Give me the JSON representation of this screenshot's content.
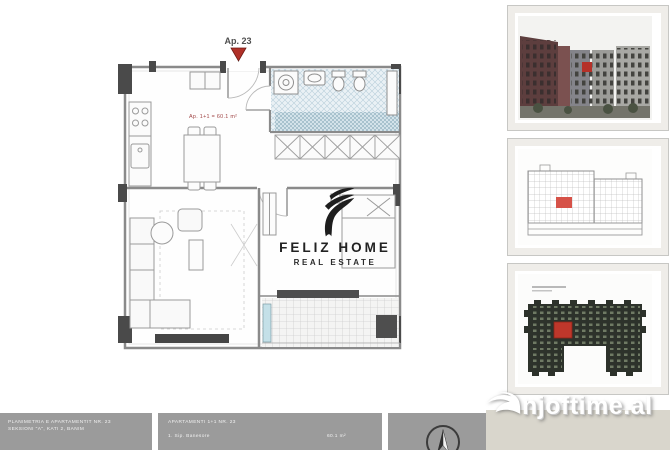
{
  "plan": {
    "unit_label": "Ap. 23",
    "area_label": "Ap. 1+1 = 60.1 m²"
  },
  "logo": {
    "name": "FELIZ HOME",
    "tagline": "REAL ESTATE"
  },
  "thumbnails": [
    {
      "label": "building-render"
    },
    {
      "label": "building-elevation"
    },
    {
      "label": "site-plan"
    }
  ],
  "footer": {
    "left_line1": "PLANIMETRIA E APARTAMENTIT NR. 23",
    "left_line2": "SEKSIONI \"A\", KATI 2, BANIM",
    "mid_title": "APARTAMENTI 1+1 NR. 23",
    "mid_item": "1. Sip. Banesore",
    "mid_value": "60.1 m²"
  },
  "watermark": {
    "text": "njoftime.al"
  },
  "icons": {
    "marker": "map-pin-triangle",
    "compass": "north-compass",
    "dove": "dove-bird"
  },
  "colors": {
    "accent_red": "#b03028",
    "footer_gray": "#9b9b9b",
    "beige": "#d9d6cc",
    "wall_gray": "#8a8a8a",
    "column_dark": "#4a4a4a"
  }
}
